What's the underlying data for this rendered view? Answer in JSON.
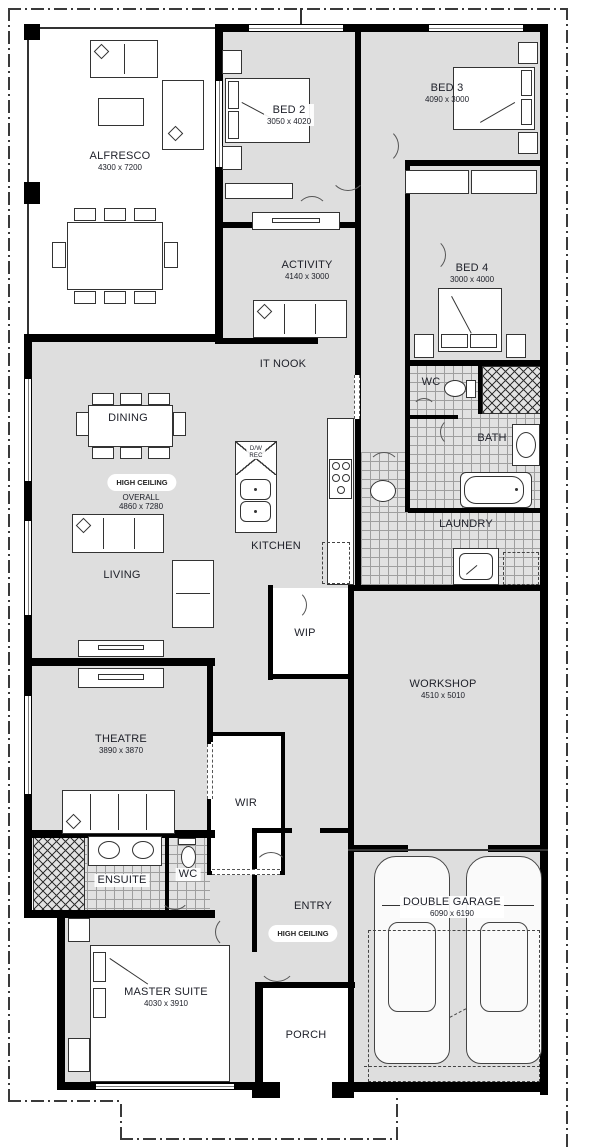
{
  "plan": {
    "type": "residential-floor-plan",
    "colors": {
      "wall": "#000000",
      "room_fill": "#dedede",
      "tile_fill": "#e2e2e2",
      "text": "#20222b"
    },
    "rooms": {
      "alfresco": {
        "label": "ALFRESCO",
        "dims": "4300 x 7200"
      },
      "bed2": {
        "label": "BED 2",
        "dims": "3050 x 4020"
      },
      "bed3": {
        "label": "BED 3",
        "dims": "4090 x 3000"
      },
      "activity": {
        "label": "ACTIVITY",
        "dims": "4140 x 3000"
      },
      "bed4": {
        "label": "BED 4",
        "dims": "3000 x 4000"
      },
      "itnook": {
        "label": "IT NOOK"
      },
      "dining": {
        "label": "DINING"
      },
      "kitchen": {
        "label": "KITCHEN"
      },
      "living": {
        "label": "LIVING"
      },
      "wc1": {
        "label": "WC"
      },
      "bath": {
        "label": "BATH"
      },
      "laundry": {
        "label": "LAUNDRY"
      },
      "wip": {
        "label": "WIP"
      },
      "workshop": {
        "label": "WORKSHOP",
        "dims": "4510 x 5010"
      },
      "theatre": {
        "label": "THEATRE",
        "dims": "3890 x 3870"
      },
      "wir": {
        "label": "WIR"
      },
      "ensuite": {
        "label": "ENSUITE"
      },
      "wc2": {
        "label": "WC"
      },
      "entry": {
        "label": "ENTRY"
      },
      "master": {
        "label": "MASTER SUITE",
        "dims": "4030 x 3910"
      },
      "porch": {
        "label": "PORCH"
      },
      "garage": {
        "label": "DOUBLE GARAGE",
        "dims": "6090 x 6190"
      }
    },
    "annotations": {
      "high_ceiling_living": "HIGH CEILING",
      "overall_label": "OVERALL",
      "overall_dims": "4860 x 7280",
      "high_ceiling_entry": "HIGH CEILING",
      "dishwasher_line1": "D/W",
      "dishwasher_line2": "REC"
    }
  }
}
